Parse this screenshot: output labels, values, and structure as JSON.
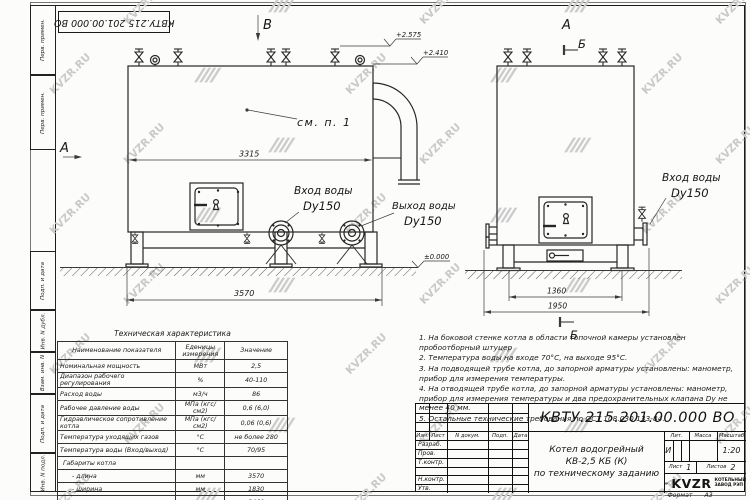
{
  "frame": {
    "top_stamp": "КВТУ.215.201.00.000 ВО",
    "format_label": "Формат",
    "format_value": "А3",
    "side_boxes": [
      "Перв. примен.",
      "Перв. примен.",
      "Подп. и дата",
      "Инв. N дубл.",
      "Взам. инв. N",
      "Подп. и дата",
      "Инв. N подл."
    ]
  },
  "drawing": {
    "view_b": "В",
    "view_a": "А",
    "section_b": "Б",
    "see_note": "см. п. 1",
    "dim_3315": "3315",
    "dim_3570": "3570",
    "dim_1360": "1360",
    "dim_1950": "1950",
    "elev_top": "+2.575",
    "elev_body": "+2.410",
    "elev_ground": "±0.000",
    "inlet_label": "Вход воды",
    "inlet_size": "Dy150",
    "outlet_label": "Выход воды",
    "outlet_size": "Dy150"
  },
  "tech_table": {
    "title": "Техническая характеристика",
    "headers": [
      "Наименование показателя",
      "Еденицы измерения",
      "Значение"
    ],
    "rows": [
      [
        "Номинальная мощность",
        "МВт",
        "2,5"
      ],
      [
        "Диапазон рабочего регулирования",
        "%",
        "40-110"
      ],
      [
        "Расход воды",
        "м3/ч",
        "86"
      ],
      [
        "Рабочее давление воды",
        "МПа (кгс/см2)",
        "0,6 (6,0)"
      ],
      [
        "Гидравлическое сопротивление котла",
        "МПа (кгс/см2)",
        "0,06 (0,6)"
      ],
      [
        "Температура уходящих газов",
        "°С",
        "не более 280"
      ],
      [
        "Температура воды (Вход/выход)",
        "°С",
        "70/95"
      ],
      [
        "Габариты котла",
        "",
        ""
      ],
      [
        "- длина",
        "мм",
        "3570"
      ],
      [
        "- ширина",
        "мм",
        "1830"
      ],
      [
        "- высота",
        "мм",
        "2460"
      ]
    ]
  },
  "notes": {
    "items": [
      "1. На боковой стенке котла в области топочной камеры установлен пробоотборный штуцер",
      "2. Температура воды на входе 70°С, на выходе 95°С.",
      "3. На подводящей трубе котла, до запорной арматуры установлены: манометр, прибор для измерения температуры.",
      "4. На отводящей трубе котла, до запорной арматуры установлены: манометр, прибор для измерения температуры и два предохранительных клапана Dу не менее 40 мм.",
      "5. Остальные технические требования по ОСТ 108.030.133-84."
    ]
  },
  "title_block": {
    "doc_number": "КВТУ.215.201.00.000 ВО",
    "rev_cols": [
      "Изм.",
      "Лист",
      "N докум.",
      "Подп.",
      "Дата"
    ],
    "sign_rows": [
      "Разраб.",
      "Пров.",
      "Т.контр.",
      "",
      "Н.контр.",
      "Утв."
    ],
    "title_line1": "Котел водогрейный",
    "title_line2": "КВ-2,5 КБ (К)",
    "title_line3": "по техническому заданию",
    "lit_label": "Лит.",
    "mass_label": "Масса",
    "scale_label": "Масштаб",
    "lit": "И",
    "scale": "1:20",
    "sheet_label": "Лист",
    "sheet": "1",
    "sheets_label": "Листов",
    "sheets": "2",
    "logo": "KVZR",
    "logo_sub1": "КОТЕЛЬНЫЙ",
    "logo_sub2": "ЗАВОД РЭП"
  },
  "watermark": {
    "text": "KVZR.RU"
  }
}
